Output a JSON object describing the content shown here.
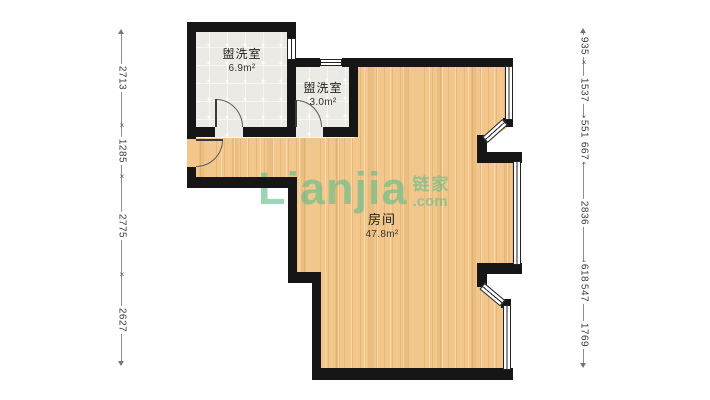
{
  "watermark": {
    "logo": "Lianjia",
    "brand_cn": "链家",
    "brand_domain": ".com"
  },
  "rooms": [
    {
      "name": "盥洗室",
      "area": "6.9m²"
    },
    {
      "name": "盥洗室",
      "area": "3.0m²"
    },
    {
      "name": "房间",
      "area": "47.8m²"
    }
  ],
  "dimensions": {
    "left": [
      "2713",
      "1285",
      "2775",
      "2627"
    ],
    "right": [
      "935",
      "1537",
      "551",
      "667",
      "2836",
      "618",
      "547",
      "1769"
    ]
  },
  "glyphs": {
    "tick": "×"
  },
  "colors": {
    "wall": "#161616",
    "wood_floor": "#f3c78b",
    "tile_floor": "#ebeae5",
    "watermark_green": "#60be8c",
    "dimension_text": "#3c3c3c"
  }
}
